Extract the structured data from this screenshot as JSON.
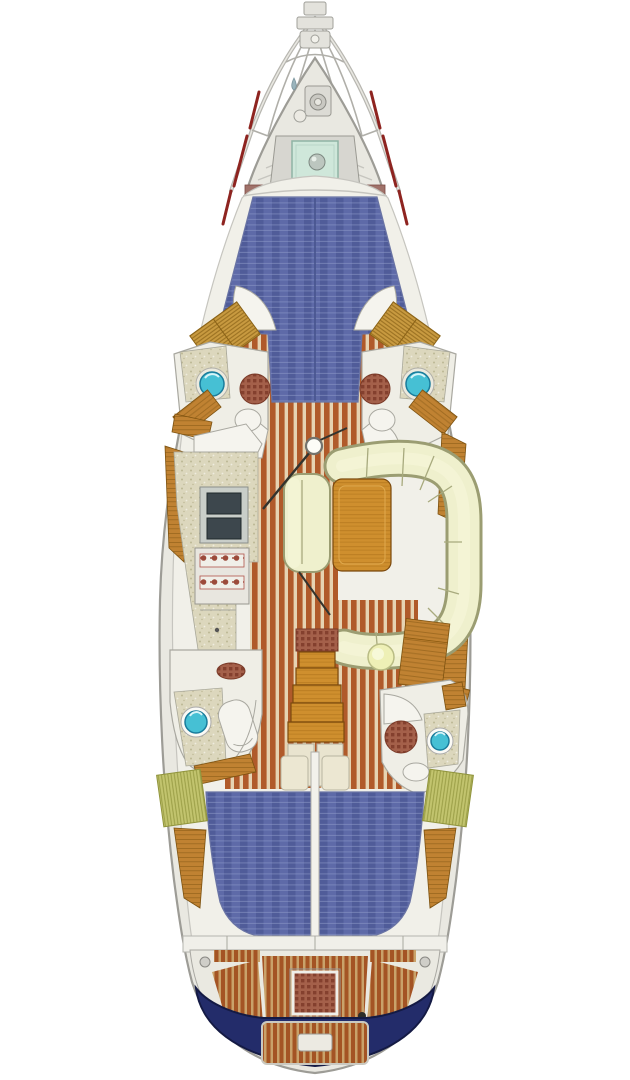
{
  "canvas": {
    "width": 630,
    "height": 1080
  },
  "palette": {
    "bg": "#ffffff",
    "hullFill": "#e9e8e1",
    "hullLine": "#9d9c96",
    "deckInner": "#f1f0e9",
    "deckEdge": "#c6c5bf",
    "white": "#f5f4ee",
    "fixtureLine": "#a9a8a0",
    "teakDark": "#b05a2a",
    "teakLight": "#e6d3b2",
    "teakCockpitDark": "#a45424",
    "teakCockpitLight": "#c9a26a",
    "berthBlue": "#5e6aa8",
    "berthBlueDark": "#475490",
    "berthBlueLight": "#8e9ac8",
    "cream": "#eff0cd",
    "creamShadow": "#9b9d72",
    "creamSeam": "#a8aa7e",
    "creamHighlight": "#f6f7da",
    "tableWood": "#cf8f2e",
    "tableWoodLine": "#a36a14",
    "wood": "#c08232",
    "woodDark": "#7d5210",
    "speckleBase": "#dcd7bd",
    "speckleDot": "#bdb795",
    "speckleDot2": "#efece0",
    "sinkTeal": "#46c0d4",
    "sinkTealDark": "#1a7c9c",
    "grateBase": "#a4604a",
    "grateDot": "#84402e",
    "darkSink": "#3d474d",
    "stoveBody": "#e8e6df",
    "burnerRed": "#9c4a3a",
    "navy": "#232c6a",
    "navyDark": "#141a44",
    "red": "#8e2420",
    "hatchGold": "#c89a40",
    "hatchGoldLine": "#8a6216",
    "hatchGreen": "#c2c46e",
    "hatchGreenLine": "#90943c",
    "stool": "#eef0b6",
    "stoolLine": "#b9bc84",
    "hatchTeal": "#cfe7da",
    "hatchTealLine": "#8fb4a4",
    "bandBrown": "#a0726a"
  },
  "areas": [
    "mast-head-fittings",
    "bow-pulpit",
    "anchor-windlass",
    "foredeck-hatch",
    "windlass-band",
    "v-berth",
    "hanging-locker-port-fwd",
    "hanging-locker-stbd-fwd",
    "head-port-fwd",
    "head-stbd-fwd",
    "galley",
    "salon-settee",
    "salon-table",
    "salon-chair",
    "mast-post",
    "companionway-stairs",
    "nav-station",
    "nav-stool",
    "head-port-aft",
    "head-stbd-aft",
    "aft-berth-port",
    "aft-berth-stbd",
    "hanging-locker-port-aft",
    "hanging-locker-stbd-aft",
    "cockpit",
    "cockpit-grate-table",
    "swim-platform",
    "stern-hull"
  ]
}
